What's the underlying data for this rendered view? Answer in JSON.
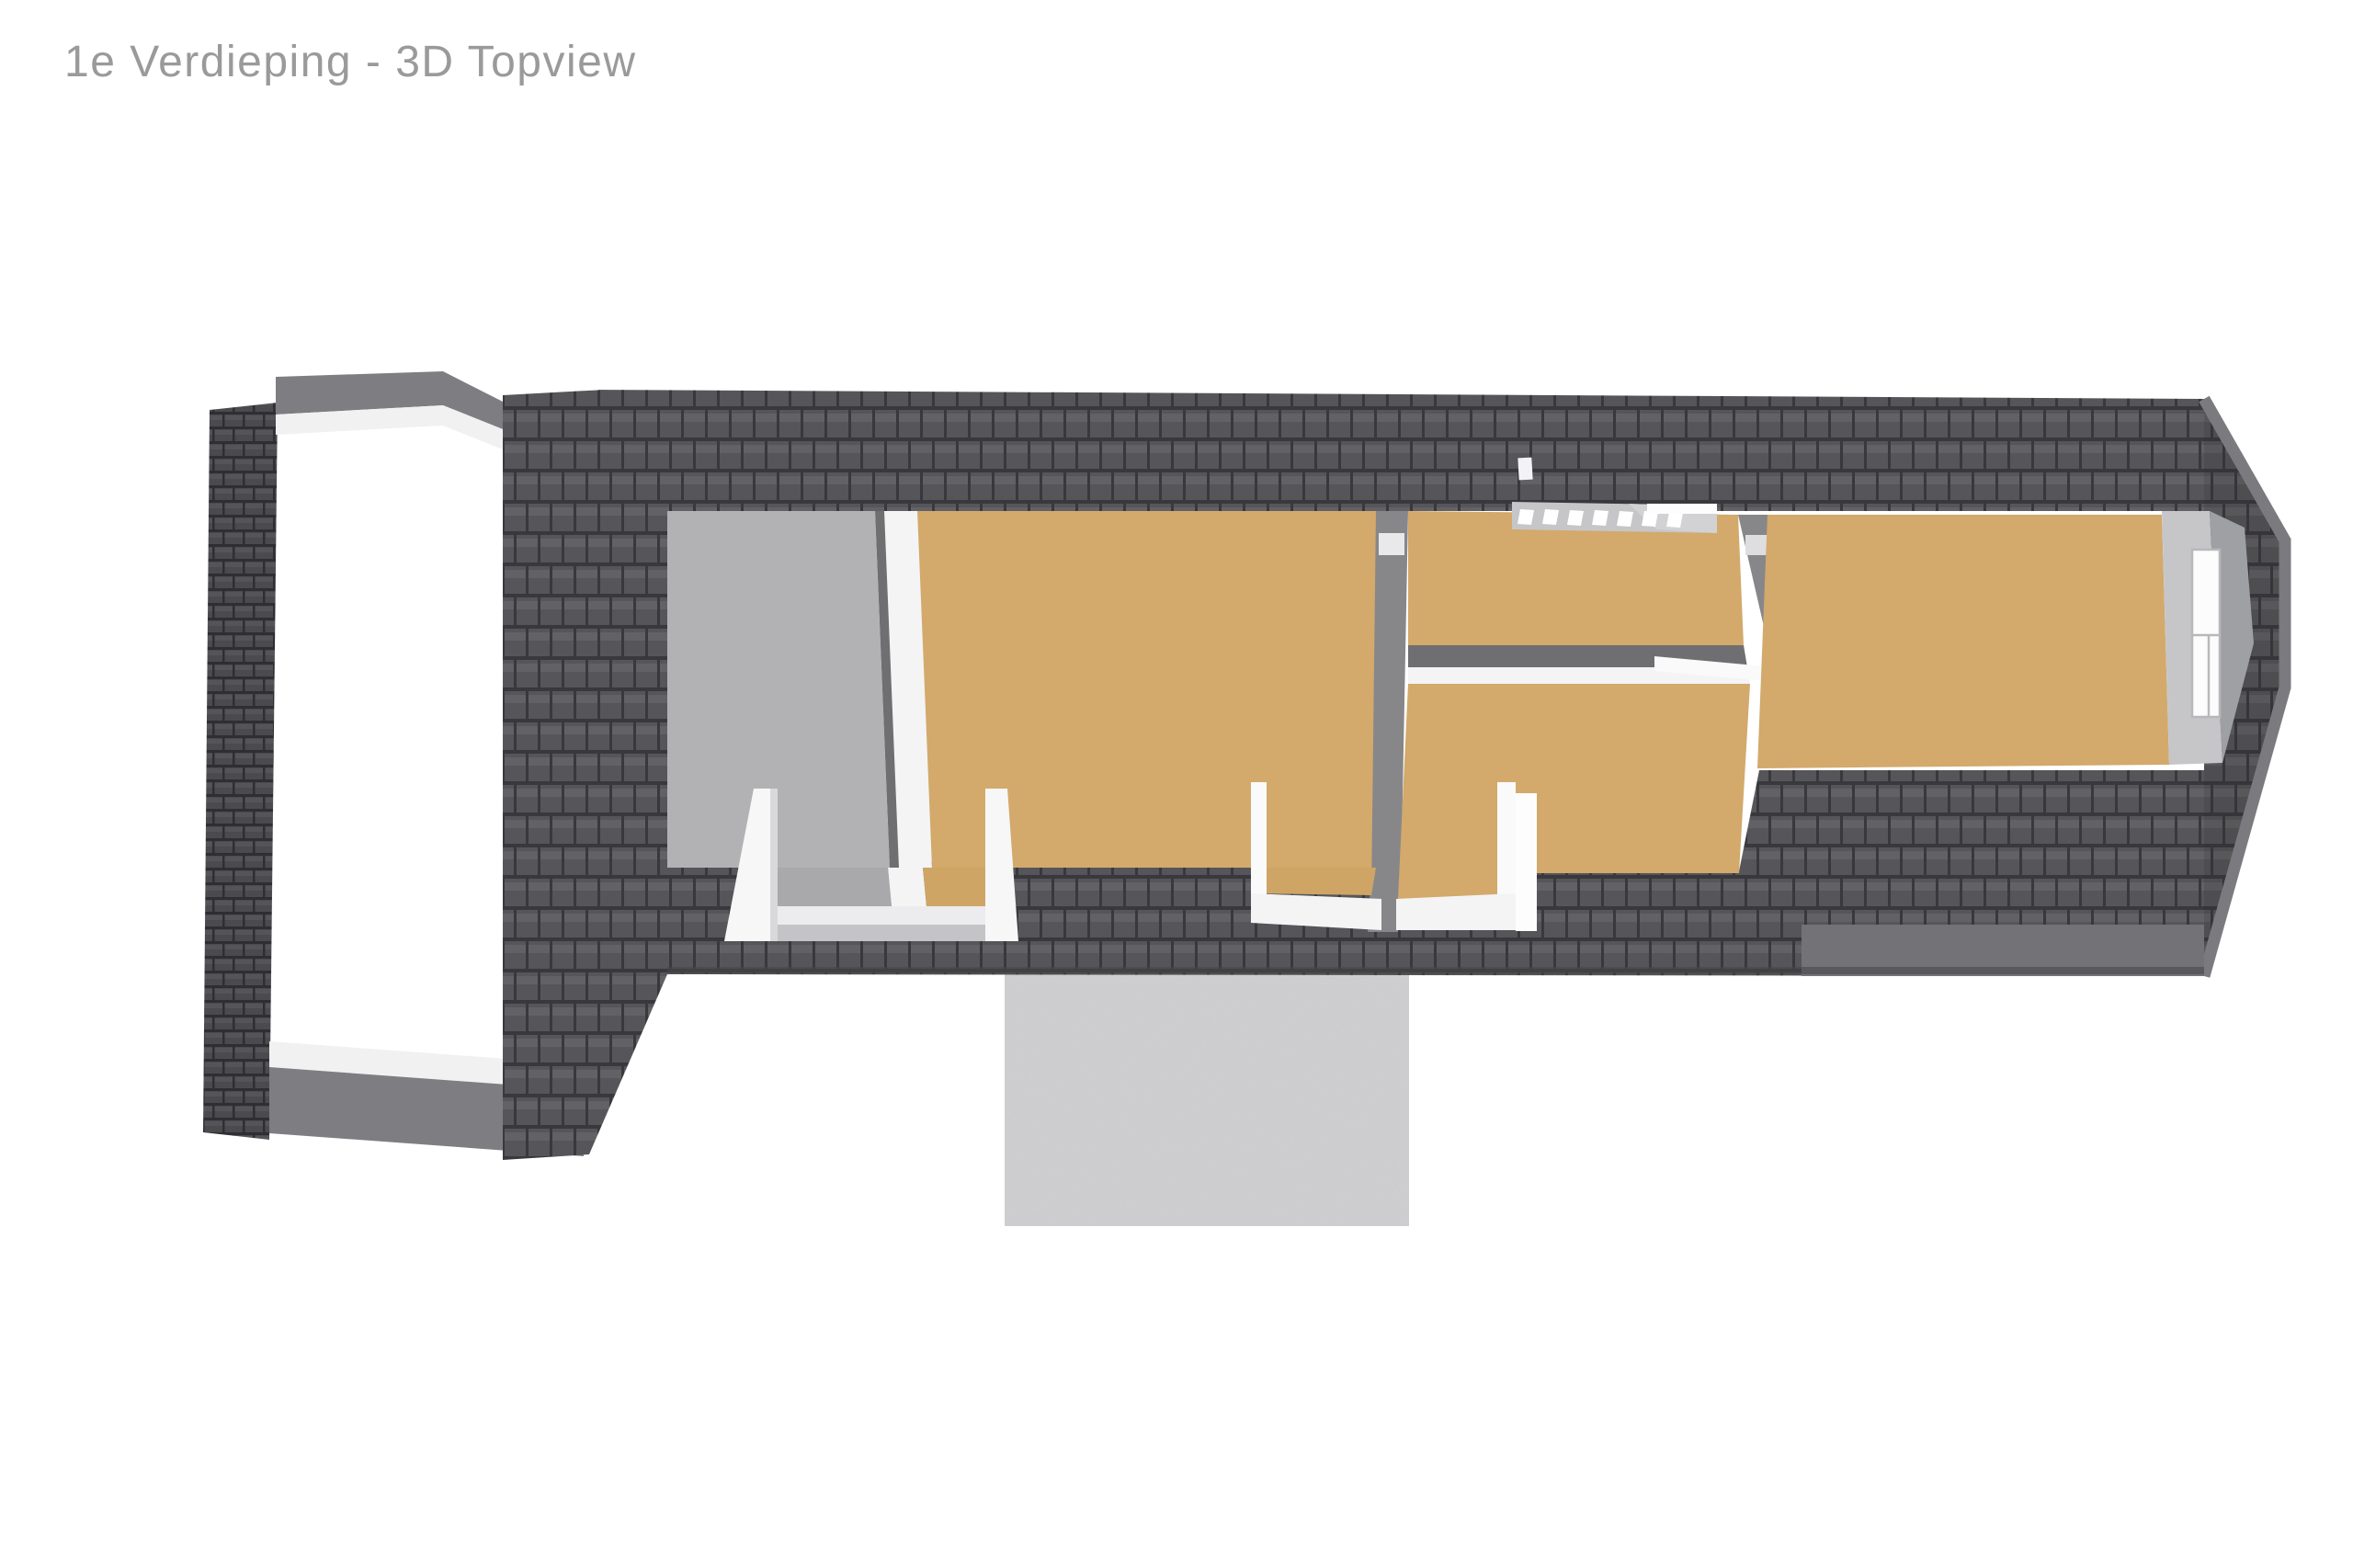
{
  "page": {
    "title": "1e Verdieping - 3D Topview",
    "background": "#ffffff",
    "title_color": "#9a9a9a"
  },
  "floorplan": {
    "floor_label": "1e Verdieping",
    "view_label": "3D Topview",
    "colors": {
      "page_bg": "#ffffff",
      "title_color": "#9a9a9a",
      "roof_base": "#56565a",
      "roof_line": "#39393d",
      "roof_small_base": "#4b4b4f",
      "roof_small_line": "#2f2f33",
      "fascia_gray": "#7e7e82",
      "fascia_white": "#f1f1f2",
      "floor_tan": "#d3a96c",
      "floor_tan_dark": "#cfa566",
      "floor_gray": "#b2b2b4",
      "wall_white": "#f4f4f5",
      "wall_gray": "#87878a",
      "wall_dark": "#6f6f72",
      "gable_light": "#c6c6c9",
      "gable_mid": "#9fa0a3",
      "stair_base": "#c6c6c8",
      "tread_white": "#ffffff",
      "concrete": "#cbcbcd",
      "window_white": "#fcfcfd",
      "window_line": "#b8b8bb"
    },
    "regions": [
      "left-annex-roof-opening",
      "gray-floor-room",
      "tan-room-left",
      "tan-room-middle-top",
      "tan-room-middle-bottom",
      "tan-room-right",
      "staircase",
      "dormer-1",
      "dormer-2",
      "gable-window",
      "roof-vent",
      "concrete-terrace"
    ]
  }
}
